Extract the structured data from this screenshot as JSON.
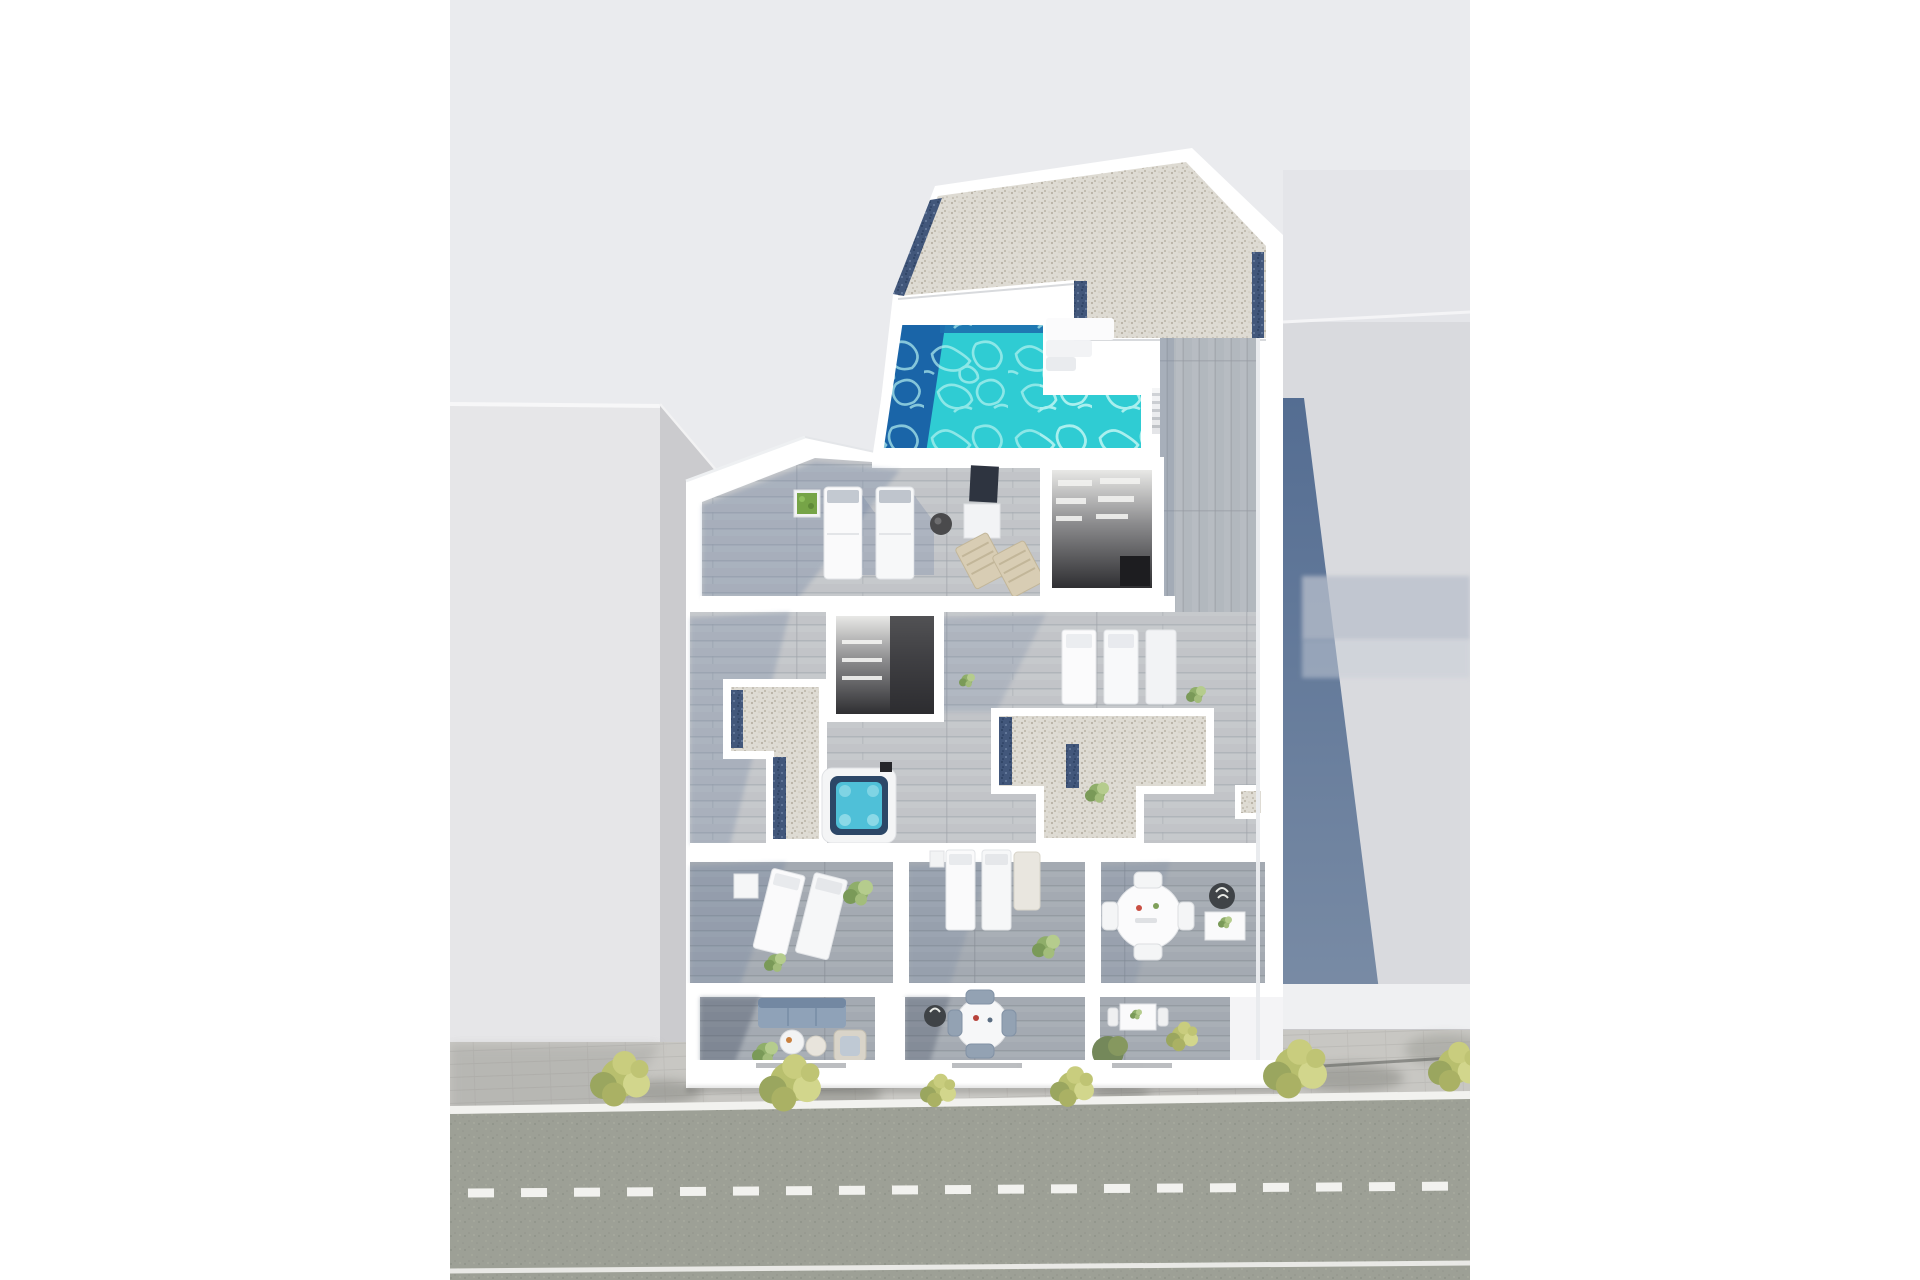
{
  "scene": {
    "kind": "aerial 3d cutaway floor-plan render of an apartment building",
    "no_visible_text": true,
    "elements": [
      "roof-gravel-terrace",
      "pool",
      "pool-deep-end",
      "pool-steps",
      "roof-stairs",
      "solarium-deck",
      "sun-loungers",
      "folding-chairs",
      "stairwell-opening",
      "gravel-terrace-left",
      "gravel-terrace-right",
      "jacuzzi",
      "bedroom-beds",
      "lounger-rooms",
      "dining-table",
      "ground-floor-terraces",
      "sofa",
      "coffee-tables",
      "street-sidewalk",
      "street-trees",
      "road",
      "road-center-dashes",
      "left-background-building",
      "right-background-building",
      "building-shadow"
    ]
  },
  "colors": {
    "margin": "#ffffff",
    "canvas_bg": "#eaebee",
    "building_white": "#ffffff",
    "wall_shade": "#e7e9ec",
    "gravel_base": "#dedbd3",
    "gravel_dot": "#b7b1a4",
    "trim_blue": "#42577b",
    "trim_dot": "#2d4262",
    "pool_water": "#2fccd3",
    "pool_deep": "#1a65a8",
    "caustic": "#b8f4f1",
    "wood_light": "#c6c9cc",
    "wood_mid": "#b7bcc2",
    "wood_dark": "#a9afb6",
    "interior_dark": "#3a3a3d",
    "slate_shadow": "#5e7697",
    "overlay_shadow": "#62789b",
    "bg_left": "#e6e6e8",
    "bg_left_facet": "#cbcbce",
    "bg_right": "#d9dade",
    "bg_right_top": "#e4e5e9",
    "bg_right_front": "#eff0f2",
    "sidewalk": "#c8c7c3",
    "road": "#9da096",
    "road_line": "#f2f2ef",
    "tree_main": "#b8bf6e",
    "tree_light": "#d2d68c",
    "tree_dark": "#9aa65f",
    "bush_dark": "#74885a",
    "sofa_blue": "#8fa2b8",
    "jacuzzi_rim": "#2c4767",
    "jacuzzi_water": "#4fc0d8",
    "beige_chair": "#d8cdb4"
  },
  "road_markings": {
    "dash_length_px": 26,
    "dash_gap_px": 27,
    "edge_line_width_px": 8,
    "dash_line_width_px": 9
  }
}
